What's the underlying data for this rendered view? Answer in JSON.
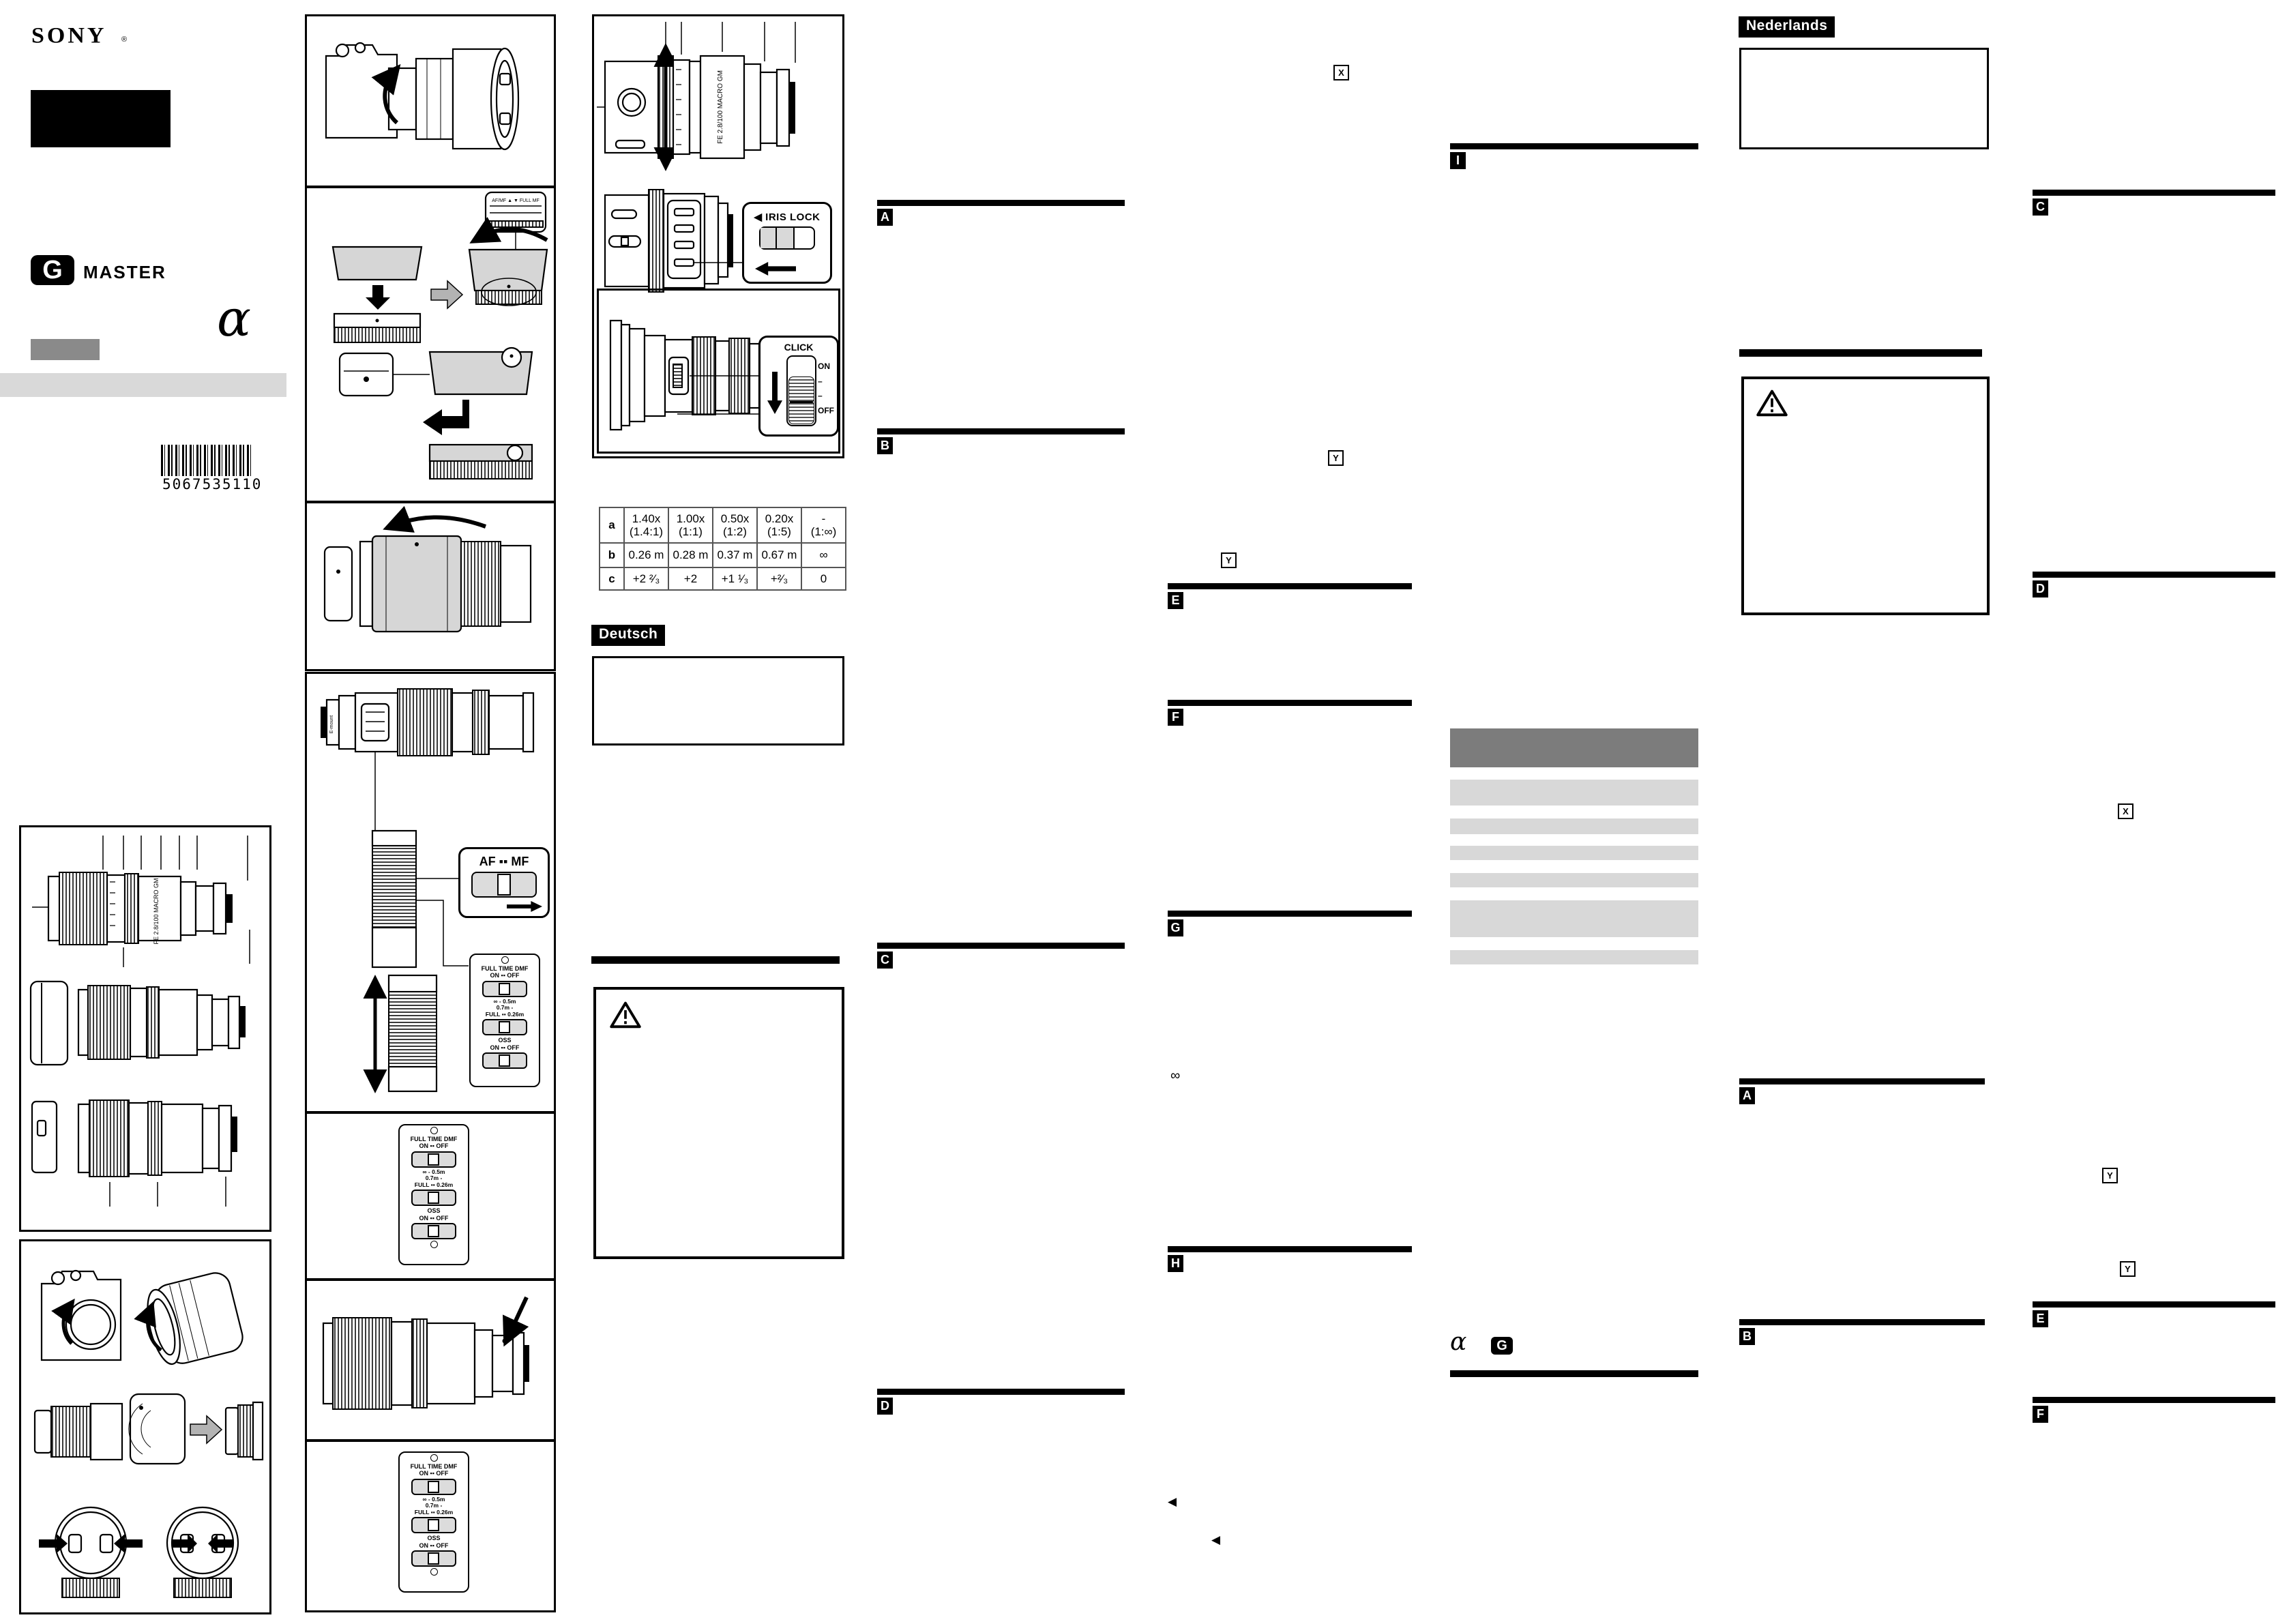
{
  "brand": {
    "sony": "SONY",
    "registered": "®",
    "g_letter": "G",
    "master": "MASTER",
    "alpha": "α"
  },
  "barcode": {
    "number": "5067535110"
  },
  "language_labels": {
    "deutsch": "Deutsch",
    "nederlands": "Nederlands"
  },
  "lens": {
    "name": "FE 2.8/100 MACRO GM"
  },
  "switches": {
    "iris_lock": "◀ IRIS LOCK",
    "click": "CLICK",
    "on": "ON",
    "off": "OFF",
    "dash": "–",
    "af_mf": "AF ▪▪ MF",
    "full_time_dmf": "FULL TIME DMF",
    "on_off": "ON ▪▪ OFF",
    "range1": "∞ - 0.5m",
    "range2": "0.7m -",
    "range3": "FULL ▪▪ 0.26m",
    "oss": "OSS"
  },
  "figure_labels": {
    "hood_scale": "AF/MF ▲ ▼ FULL MF",
    "e_mount": "E-mount"
  },
  "macro_table": {
    "labels": [
      "a",
      "b",
      "c"
    ],
    "row_a": [
      {
        "l1": "1.40x",
        "l2": "(1.4:1)"
      },
      {
        "l1": "1.00x",
        "l2": "(1:1)"
      },
      {
        "l1": "0.50x",
        "l2": "(1:2)"
      },
      {
        "l1": "0.20x",
        "l2": "(1:5)"
      },
      {
        "l1": "-",
        "l2": "(1:∞)"
      }
    ],
    "row_b": [
      "0.26 m",
      "0.28 m",
      "0.37 m",
      "0.67 m",
      "∞"
    ],
    "row_c": [
      "+2 ²⁄₃",
      "+2",
      "+1 ¹⁄₃",
      "+²⁄₃",
      "0"
    ]
  },
  "section_markers": {
    "a": "A",
    "b": "B",
    "c": "C",
    "d": "D",
    "e": "E",
    "f": "F",
    "g": "G",
    "h": "H",
    "i": "I",
    "x": "X",
    "y": "Y",
    "infinity": "∞",
    "left_triangle": "◀"
  }
}
